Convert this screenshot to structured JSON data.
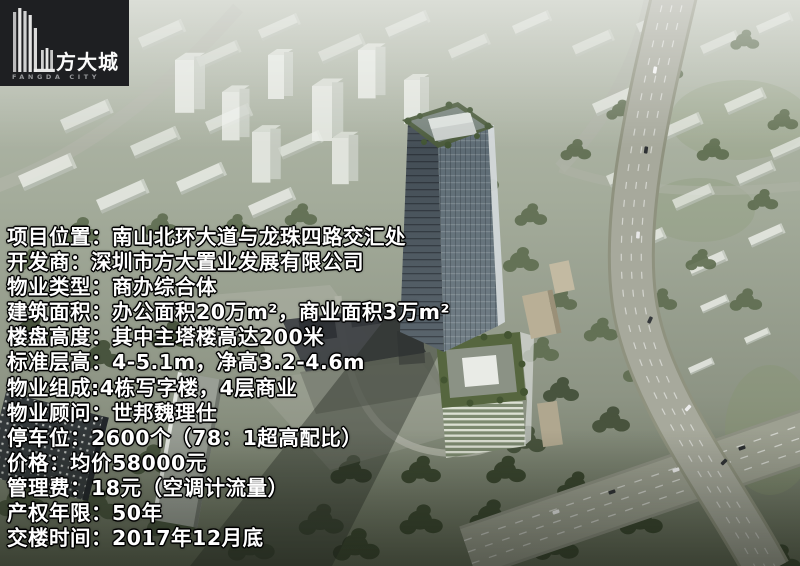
{
  "logo": {
    "title": "方大城",
    "subtitle": "FANGDA CITY"
  },
  "info": {
    "lines": [
      "项目位置：南山北环大道与龙珠四路交汇处",
      "开发商：深圳市方大置业发展有限公司",
      "物业类型：商办综合体",
      "建筑面积：办公面积20万m²，商业面积3万m²",
      "楼盘高度：其中主塔楼高达200米",
      "标准层高：4-5.1m，净高3.2-4.6m",
      "物业组成:4栋写字楼，4层商业",
      "物业顾问：世邦魏理仕",
      "停车位：2600个（78：1超高配比）",
      "价格：均价58000元",
      "管理费：18元（空调计流量）",
      "产权年限：50年",
      "交楼时间：2017年12月底"
    ]
  },
  "colors": {
    "logo_bg": "#1e1f22",
    "info_text": "#ffffff",
    "info_text_outline": "#000000",
    "roof_garden_green": "#55683f",
    "tower_glass": "#4b5860"
  }
}
